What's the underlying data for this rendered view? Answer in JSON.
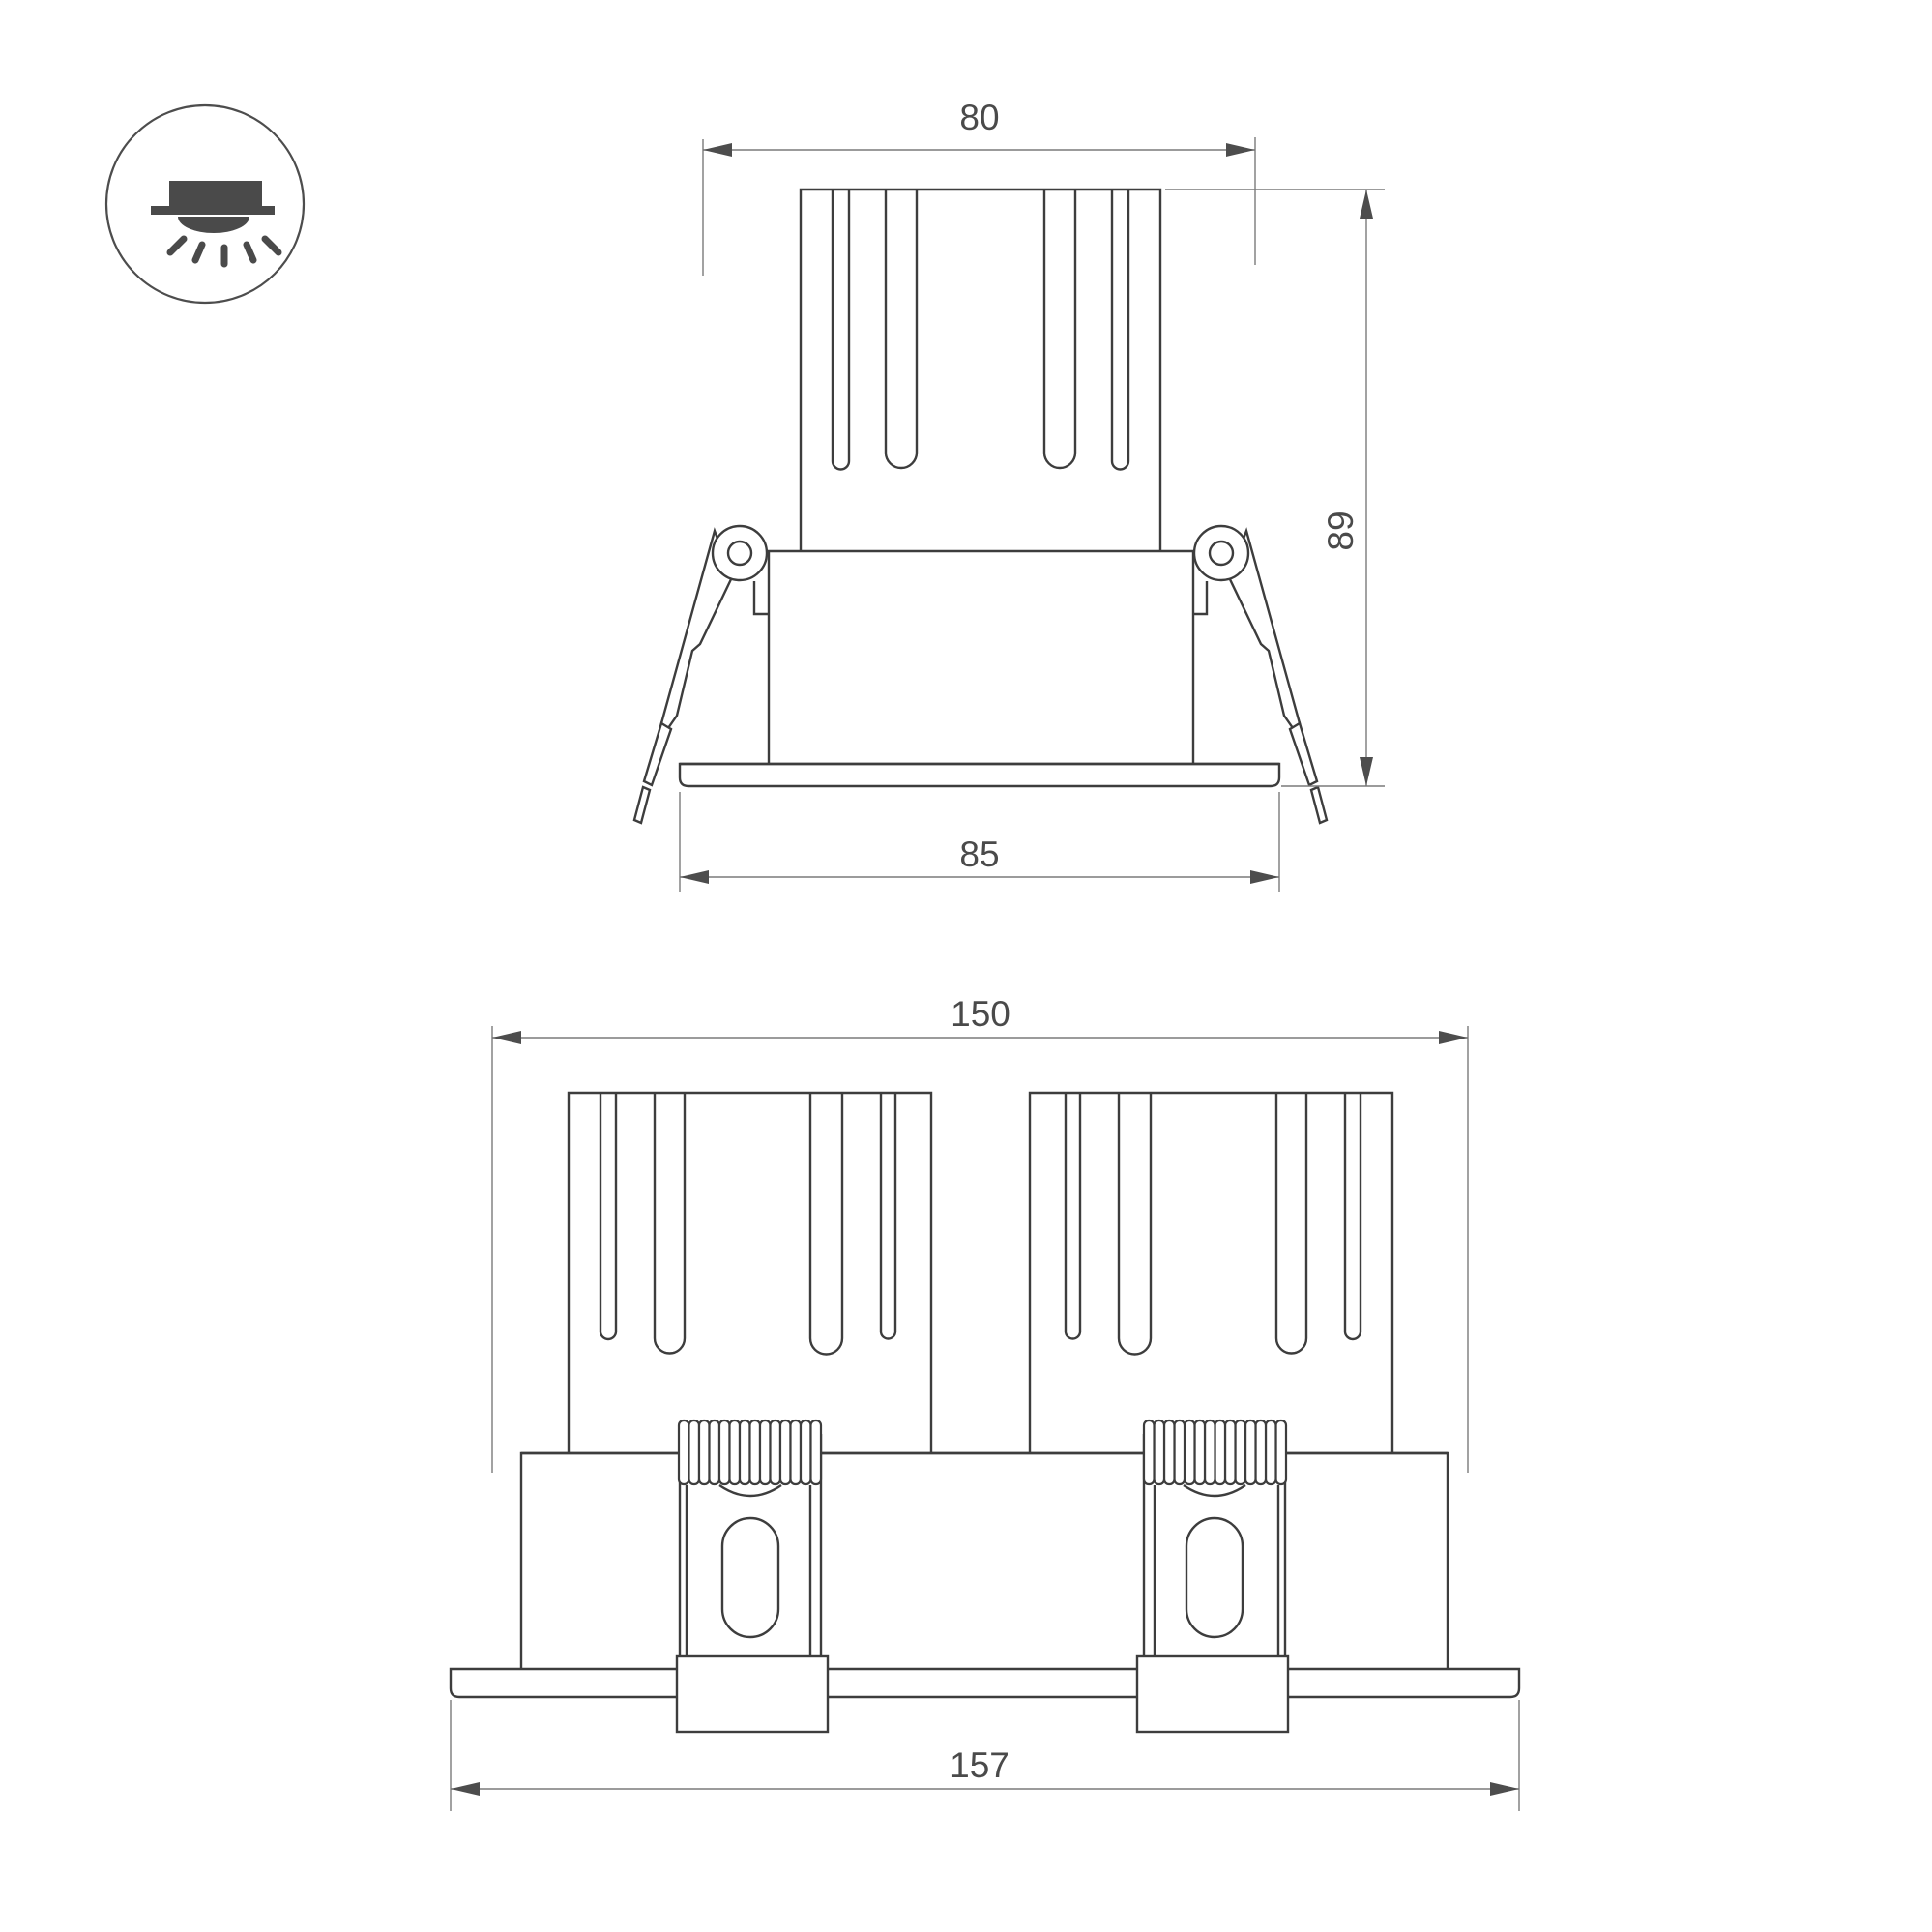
{
  "drawing": {
    "background": "#ffffff",
    "dimensions": {
      "front_top_width": "80",
      "front_height": "89",
      "front_flange_width": "85",
      "dual_body_width": "150",
      "dual_flange_width": "157"
    },
    "icon": {
      "name": "recessed-downlight-icon"
    },
    "colors": {
      "outline": "#3d3d3d",
      "dimension_line": "#7a7a7a",
      "arrow": "#4d4d4d",
      "label_text": "#4a4a4a",
      "icon_fill": "#4a4a4a"
    }
  }
}
